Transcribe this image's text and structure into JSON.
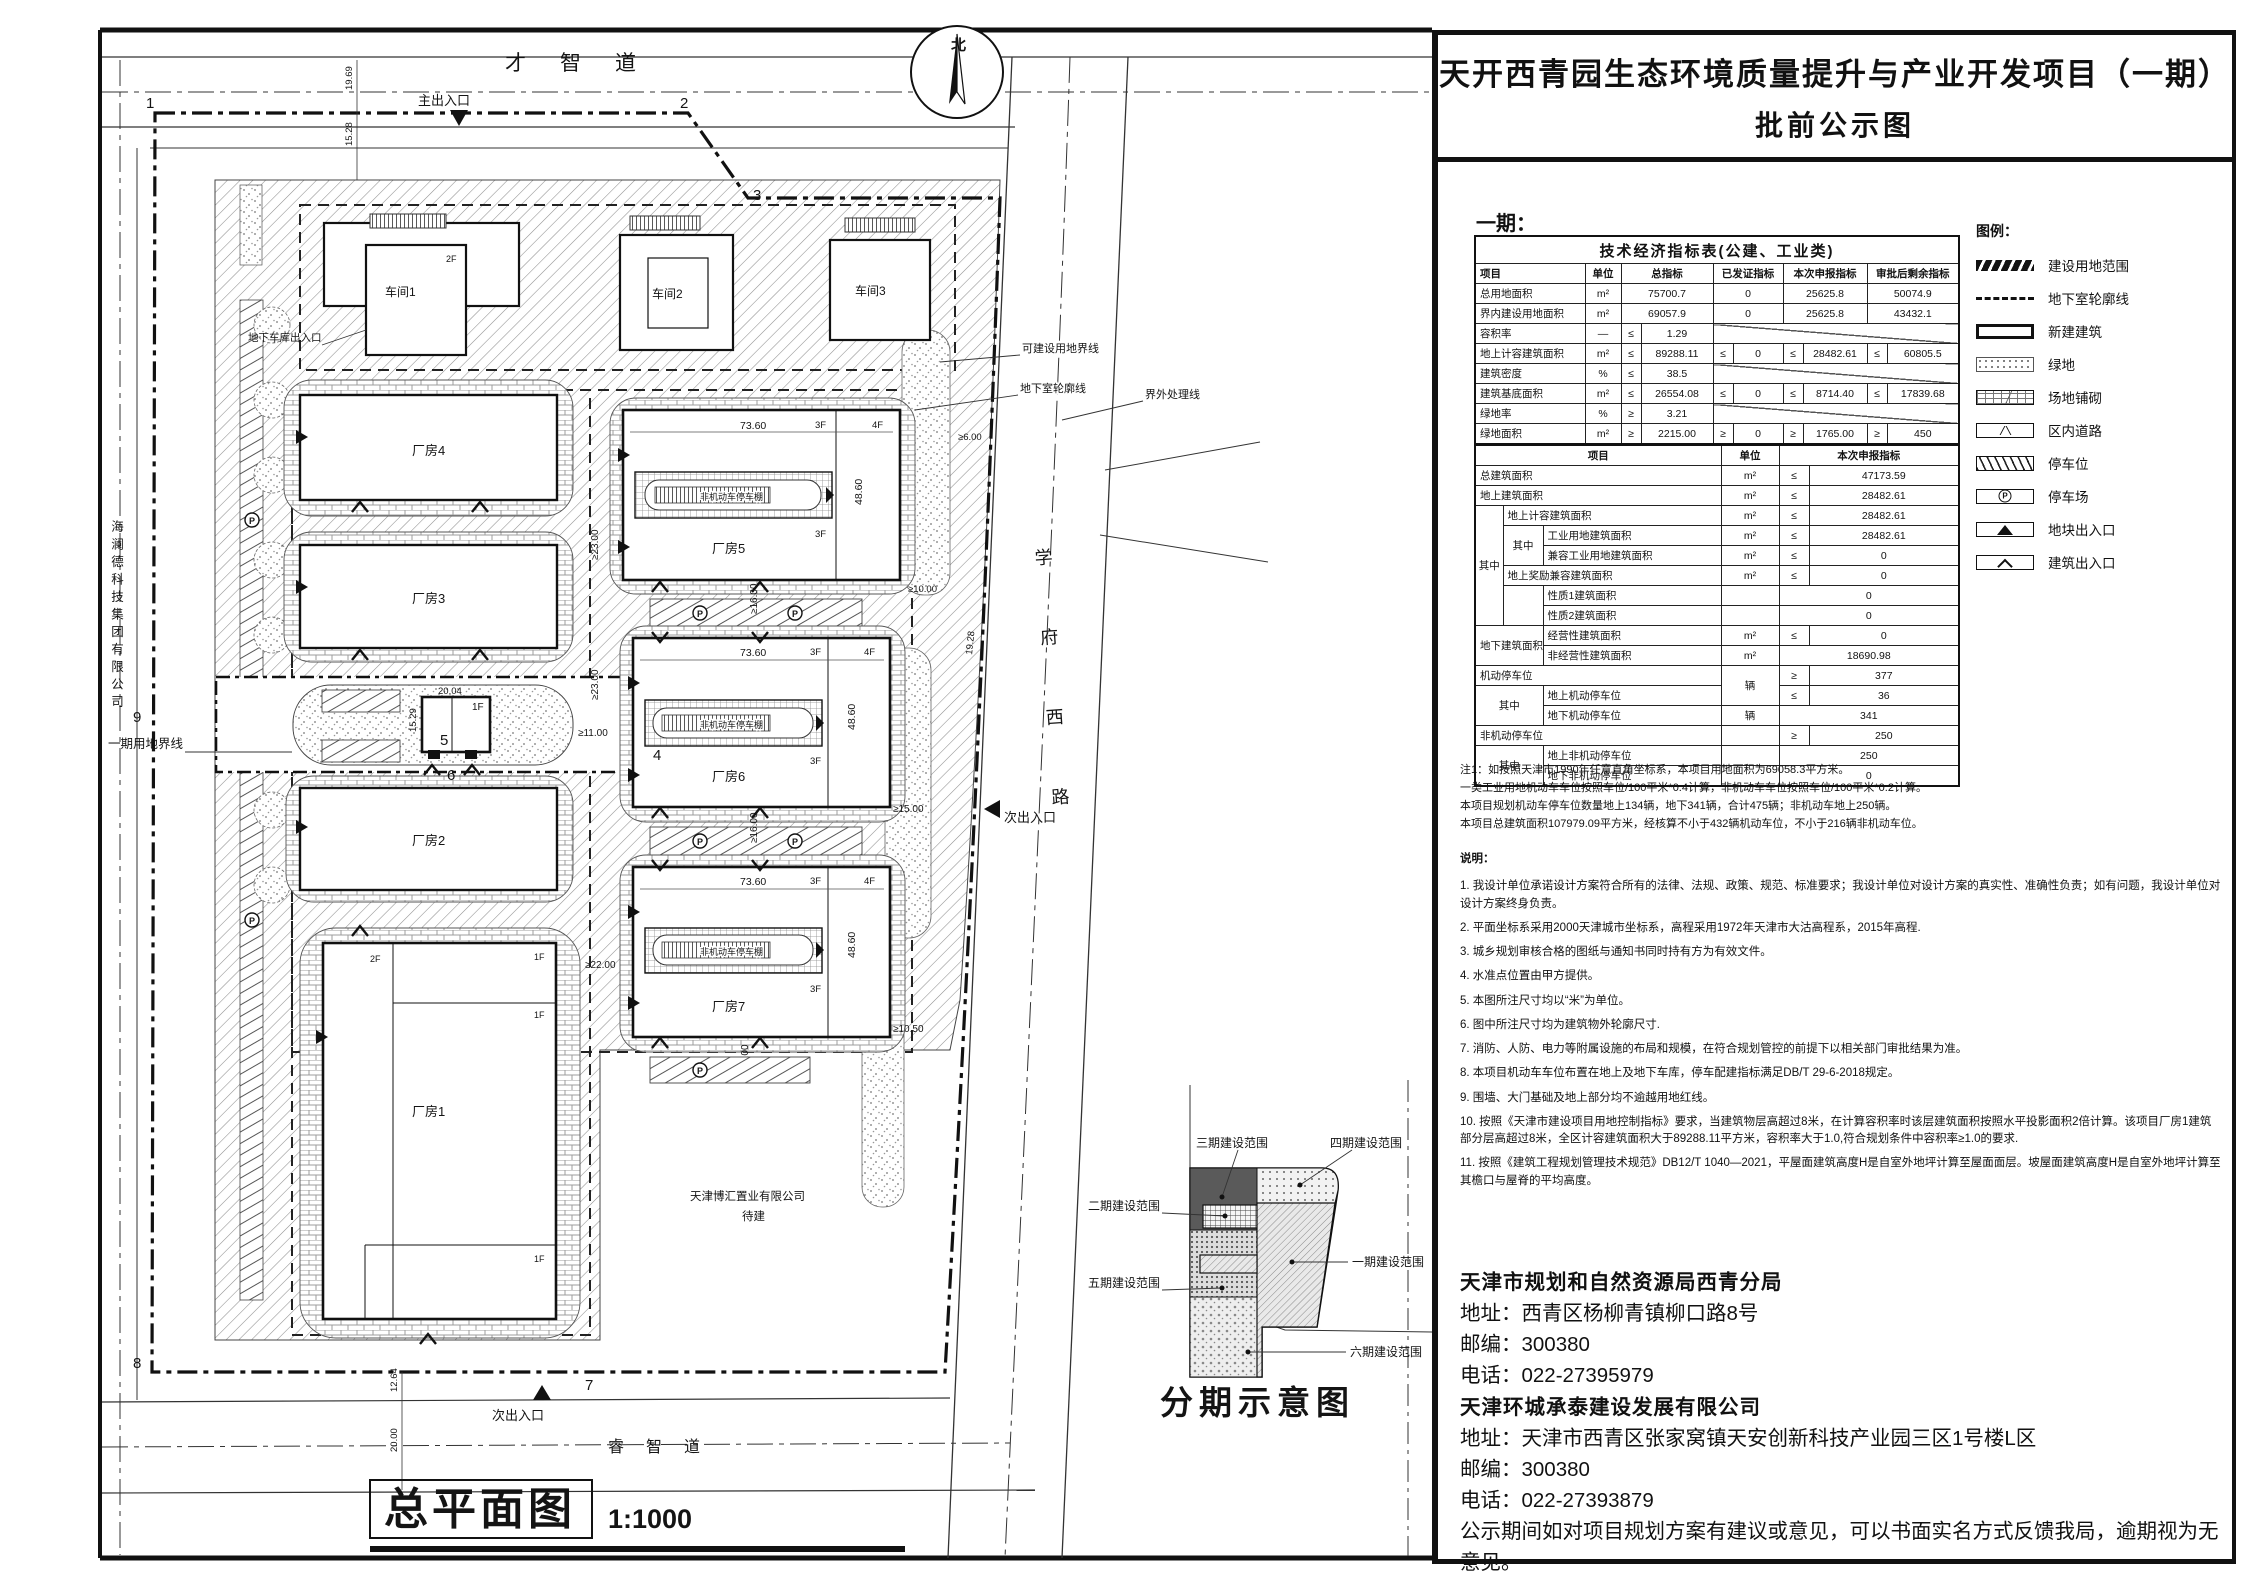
{
  "title": {
    "line1": "天开西青园生态环境质量提升与产业开发项目（一期）",
    "line2": "批前公示图"
  },
  "panel": {
    "phase_label": "一期："
  },
  "tables": {
    "indicators": {
      "colw": [
        110,
        36,
        20,
        72,
        20,
        50,
        20,
        64,
        20,
        72
      ],
      "rows": [
        [
          [
            "技术经济指标表(公建、工业类)",
            10,
            1,
            "tt"
          ]
        ],
        [
          [
            "项目",
            1,
            1,
            "hd lt"
          ],
          [
            "单位",
            1,
            1,
            "hd"
          ],
          [
            "总指标",
            2,
            1,
            "hd"
          ],
          [
            "已发证指标",
            2,
            1,
            "hd"
          ],
          [
            "本次申报指标",
            2,
            1,
            "hd"
          ],
          [
            "审批后剩余指标",
            2,
            1,
            "hd"
          ]
        ],
        [
          [
            "总用地面积",
            1,
            1,
            "lt"
          ],
          [
            "m²"
          ],
          [
            "75700.7",
            2
          ],
          [
            "0",
            2
          ],
          [
            "25625.8",
            2
          ],
          [
            "50074.9",
            2
          ]
        ],
        [
          [
            "界内建设用地面积",
            1,
            1,
            "lt"
          ],
          [
            "m²"
          ],
          [
            "69057.9",
            2
          ],
          [
            "0",
            2
          ],
          [
            "25625.8",
            2
          ],
          [
            "43432.1",
            2
          ]
        ],
        [
          [
            "容积率",
            1,
            1,
            "lt"
          ],
          [
            "—"
          ],
          [
            "≤"
          ],
          [
            "1.29"
          ],
          [
            "",
            6,
            1,
            "dg"
          ]
        ],
        [
          [
            "地上计容建筑面积",
            1,
            1,
            "lt"
          ],
          [
            "m²"
          ],
          [
            "≤"
          ],
          [
            "89288.11"
          ],
          [
            "≤"
          ],
          [
            "0"
          ],
          [
            "≤"
          ],
          [
            "28482.61"
          ],
          [
            "≤"
          ],
          [
            "60805.5"
          ]
        ],
        [
          [
            "建筑密度",
            1,
            1,
            "lt"
          ],
          [
            "%"
          ],
          [
            "≤"
          ],
          [
            "38.5"
          ],
          [
            "",
            6,
            1,
            "dg"
          ]
        ],
        [
          [
            "建筑基底面积",
            1,
            1,
            "lt"
          ],
          [
            "m²"
          ],
          [
            "≤"
          ],
          [
            "26554.08"
          ],
          [
            "≤"
          ],
          [
            "0"
          ],
          [
            "≤"
          ],
          [
            "8714.40"
          ],
          [
            "≤"
          ],
          [
            "17839.68"
          ]
        ],
        [
          [
            "绿地率",
            1,
            1,
            "lt"
          ],
          [
            "%"
          ],
          [
            "≥"
          ],
          [
            "3.21"
          ],
          [
            "",
            6,
            1,
            "dg"
          ]
        ],
        [
          [
            "绿地面积",
            1,
            1,
            "lt"
          ],
          [
            "m²"
          ],
          [
            "≥"
          ],
          [
            "2215.00"
          ],
          [
            "≥"
          ],
          [
            "0"
          ],
          [
            "≥"
          ],
          [
            "1765.00"
          ],
          [
            "≥"
          ],
          [
            "450"
          ]
        ]
      ]
    },
    "details": {
      "colw": [
        28,
        40,
        178,
        58,
        30,
        150
      ],
      "rows": [
        [
          [
            "项目",
            3,
            1,
            "hd"
          ],
          [
            "单位",
            1,
            1,
            "hd"
          ],
          [
            "本次申报指标",
            2,
            1,
            "hd"
          ]
        ],
        [
          [
            "总建筑面积",
            3,
            1,
            "lt"
          ],
          [
            "m²"
          ],
          [
            "≤"
          ],
          [
            "47173.59"
          ]
        ],
        [
          [
            "地上建筑面积",
            3,
            1,
            "lt"
          ],
          [
            "m²"
          ],
          [
            "≤"
          ],
          [
            "28482.61"
          ]
        ],
        [
          [
            "其中",
            1,
            6
          ],
          [
            "地上计容建筑面积",
            2,
            1,
            "lt"
          ],
          [
            "m²"
          ],
          [
            "≤"
          ],
          [
            "28482.61"
          ]
        ],
        [
          [
            "其中",
            1,
            2
          ],
          [
            "工业用地建筑面积",
            1,
            1,
            "lt"
          ],
          [
            "m²"
          ],
          [
            "≤"
          ],
          [
            "28482.61"
          ]
        ],
        [
          [
            "兼容工业用地建筑面积",
            1,
            1,
            "lt"
          ],
          [
            "m²"
          ],
          [
            "≤"
          ],
          [
            "0"
          ]
        ],
        [
          [
            "地上奖励兼容建筑面积",
            2,
            1,
            "lt"
          ],
          [
            "m²"
          ],
          [
            "≤"
          ],
          [
            "0"
          ]
        ],
        [
          [
            "",
            1,
            2
          ],
          [
            "性质1建筑面积",
            1,
            1,
            "lt"
          ],
          [
            ""
          ],
          [
            "0",
            2
          ]
        ],
        [
          [
            "性质2建筑面积",
            1,
            1,
            "lt"
          ],
          [
            ""
          ],
          [
            "0",
            2
          ]
        ],
        [
          [
            "地下建筑面积",
            2,
            2,
            "lt"
          ],
          [
            "经营性建筑面积",
            1,
            1,
            "lt"
          ],
          [
            "m²"
          ],
          [
            "≤"
          ],
          [
            "0"
          ]
        ],
        [
          [
            "非经营性建筑面积",
            1,
            1,
            "lt"
          ],
          [
            "m²"
          ],
          [
            "18690.98",
            2
          ]
        ],
        [
          [
            "机动停车位",
            3,
            1,
            "lt"
          ],
          [
            "辆",
            1,
            2
          ],
          [
            "≥"
          ],
          [
            "377"
          ]
        ],
        [
          [
            "其中",
            2,
            2
          ],
          [
            "地上机动停车位",
            1,
            1,
            "lt"
          ],
          [
            "≤"
          ],
          [
            "36"
          ]
        ],
        [
          [
            "地下机动停车位",
            1,
            1,
            "lt"
          ],
          [
            "辆"
          ],
          [
            "341",
            2
          ]
        ],
        [
          [
            "非机动停车位",
            3,
            1,
            "lt"
          ],
          [
            ""
          ],
          [
            "≥"
          ],
          [
            "250"
          ]
        ],
        [
          [
            "其中",
            2,
            2
          ],
          [
            "地上非机动停车位",
            1,
            1,
            "lt"
          ],
          [
            ""
          ],
          [
            "250",
            2
          ]
        ],
        [
          [
            "地下非机动停车位",
            1,
            1,
            "lt"
          ],
          [
            ""
          ],
          [
            "0",
            2
          ]
        ]
      ]
    }
  },
  "legend": {
    "title": "图例：",
    "items": [
      {
        "type": "boundary",
        "label": "建设用地范围"
      },
      {
        "type": "basement",
        "label": "地下室轮廓线"
      },
      {
        "type": "building",
        "label": "新建建筑"
      },
      {
        "type": "green",
        "label": "绿地"
      },
      {
        "type": "paving",
        "label": "场地铺砌"
      },
      {
        "type": "road",
        "label": "区内道路"
      },
      {
        "type": "stall",
        "label": "停车位"
      },
      {
        "type": "lot",
        "label": "停车场"
      },
      {
        "type": "site-entry",
        "label": "地块出入口"
      },
      {
        "type": "bldg-entry",
        "label": "建筑出入口"
      }
    ]
  },
  "notes": {
    "note1": [
      "注1：如按照天津市1990年任意直角坐标系，本项目用地面积为69058.3平方米。",
      "一类工业用地机动车车位按照车位/100平米*0.4计算，非机动车车位按照车位/100平米*0.2计算。",
      "本项目规划机动车停车位数量地上134辆，地下341辆，合计475辆；非机动车地上250辆。",
      "本项目总建筑面积107979.09平方米，经核算不小于432辆机动车位，不小于216辆非机动车位。"
    ],
    "heading": "说明：",
    "items": [
      "1. 我设计单位承诺设计方案符合所有的法律、法规、政策、规范、标准要求；我设计单位对设计方案的真实性、准确性负责；如有问题，我设计单位对设计方案终身负责。",
      "2. 平面坐标系采用2000天津城市坐标系，高程采用1972年天津市大沽高程系，2015年高程.",
      "3. 城乡规划审核合格的图纸与通知书同时持有方为有效文件。",
      "4. 水准点位置由甲方提供。",
      "5. 本图所注尺寸均以“米”为单位。",
      "6. 图中所注尺寸均为建筑物外轮廓尺寸.",
      "7. 消防、人防、电力等附属设施的布局和规模，在符合规划管控的前提下以相关部门审批结果为准。",
      "8. 本项目机动车车位布置在地上及地下车库，停车配建指标满足DB/T 29-6-2018规定。",
      "9. 围墙、大门基础及地上部分均不逾越用地红线。",
      "10. 按照《天津市建设项目用地控制指标》要求，当建筑物层高超过8米，在计算容积率时该层建筑面积按照水平投影面积2倍计算。该项目厂房1建筑部分层高超过8米，全区计容建筑面积大于89288.11平方米，容积率大于1.0,符合规划条件中容积率≥1.0的要求.",
      "11. 按照《建筑工程规划管理技术规范》DB12/T 1040—2021，平屋面建筑高度H是自室外地坪计算至屋面面层。坡屋面建筑高度H是自室外地坪计算至其檐口与屋脊的平均高度。"
    ]
  },
  "contact": {
    "lines": [
      "天津市规划和自然资源局西青分局",
      "地址：西青区杨柳青镇柳口路8号",
      "邮编：300380",
      "电话：022-27395979",
      "天津环城承泰建设发展有限公司",
      "地址：天津市西青区张家窝镇天安创新科技产业园三区1号楼L区",
      "邮编：300380",
      "电话：022-27393879",
      "公示期间如对项目规划方案有建议或意见，可以书面实名方式反馈我局，逾期视为无意见。"
    ]
  },
  "plan": {
    "north": "北",
    "roads": {
      "top": "才智道",
      "right": "学府西路",
      "bottom": "睿智道"
    },
    "entrances": {
      "main": "主出入口",
      "secondary": "次出入口",
      "garage": "地下车库出入口"
    },
    "lines": {
      "phase1": "一期用地界线",
      "buildable": "可建设用地界线",
      "basement": "地下室轮廓线",
      "outside": "界外处理线"
    },
    "neighbors": {
      "west": "海澜德科技集团有限公司",
      "south1": "天津博汇置业有限公司",
      "south2": "待建"
    },
    "buildings": {
      "w1": "车间1",
      "w2": "车间2",
      "w3": "车间3",
      "f1": "厂房1",
      "f2": "厂房2",
      "f3": "厂房3",
      "f4": "厂房4",
      "f5": "厂房5",
      "f6": "厂房6",
      "f7": "厂房7",
      "shed": "非机动车停车棚"
    },
    "floors": {
      "f1": "1F",
      "f2": "2F",
      "f3": "3F",
      "f4": "4F"
    },
    "dims": {
      "bw": "73.60",
      "bh": "48.60",
      "sw": "20.04",
      "sh": "15.29",
      "d23": "≥23.00",
      "d16": "≥16.00",
      "d15": "≥15.00",
      "d105": "≥10.50",
      "d22": "≥22.00",
      "d11": "≥11.00",
      "d10": "≥10.00",
      "d6": "≥6.00",
      "r1": "19.69",
      "r2": "15.28",
      "r3": "19.28",
      "r4": "12.64",
      "r5": "20.00"
    },
    "markers": [
      "1",
      "2",
      "3",
      "4",
      "5",
      "6",
      "7",
      "8",
      "9"
    ],
    "parking_p": "P",
    "caption": {
      "title": "总平面图",
      "scale": "1:1000"
    },
    "phasing": {
      "p1": "一期建设范围",
      "p2": "二期建设范围",
      "p3": "三期建设范围",
      "p4": "四期建设范围",
      "p5": "五期建设范围",
      "p6": "六期建设范围",
      "caption": "分期示意图"
    }
  }
}
